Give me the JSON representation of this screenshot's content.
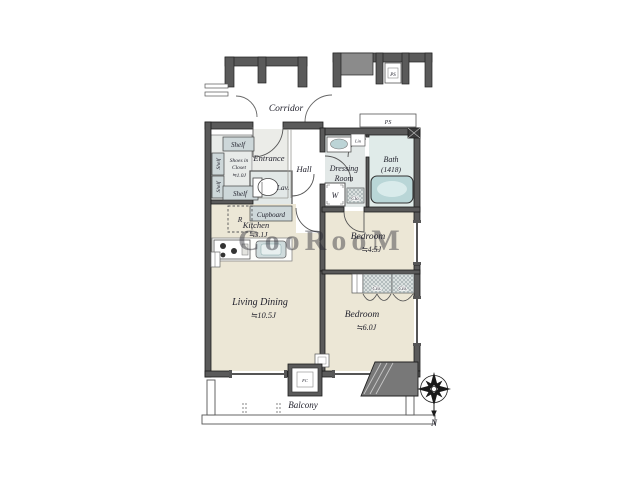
{
  "plan": {
    "corridor": "Corridor",
    "entrance": "Entrance",
    "hall": "Hall",
    "lav": "Lav.",
    "cupboard": "Cupboard",
    "shelf": "Shelf",
    "shoes_closet": {
      "line1": "Shoes in",
      "line2": "Closet",
      "size": "≒1.0J"
    },
    "kitchen": {
      "name": "Kitchen",
      "size": "≒3.1J"
    },
    "living": {
      "name": "Living Dining",
      "size": "≒10.5J"
    },
    "bedroom1": {
      "name": "Bedroom",
      "size": "≒4.5J"
    },
    "bedroom2": {
      "name": "Bedroom",
      "size": "≒6.0J"
    },
    "dressing": {
      "line1": "Dressing",
      "line2": "Room"
    },
    "bath": {
      "name": "Bath",
      "size": "(1418)"
    },
    "balcony": "Balcony",
    "washer": "W",
    "fridge": "R",
    "linen": "Lin",
    "closet": "Clo.",
    "ps": "PS",
    "fc": "FC",
    "north": "N",
    "watermark": "CooRooM"
  },
  "colors": {
    "wall": "#5a5a5a",
    "room_beige": "#ece7d6",
    "wet_area": "#e2e8e7",
    "fixture": "#cdd7d9",
    "tub": "#b9d6d7",
    "watermark": "#b8cfdb"
  }
}
